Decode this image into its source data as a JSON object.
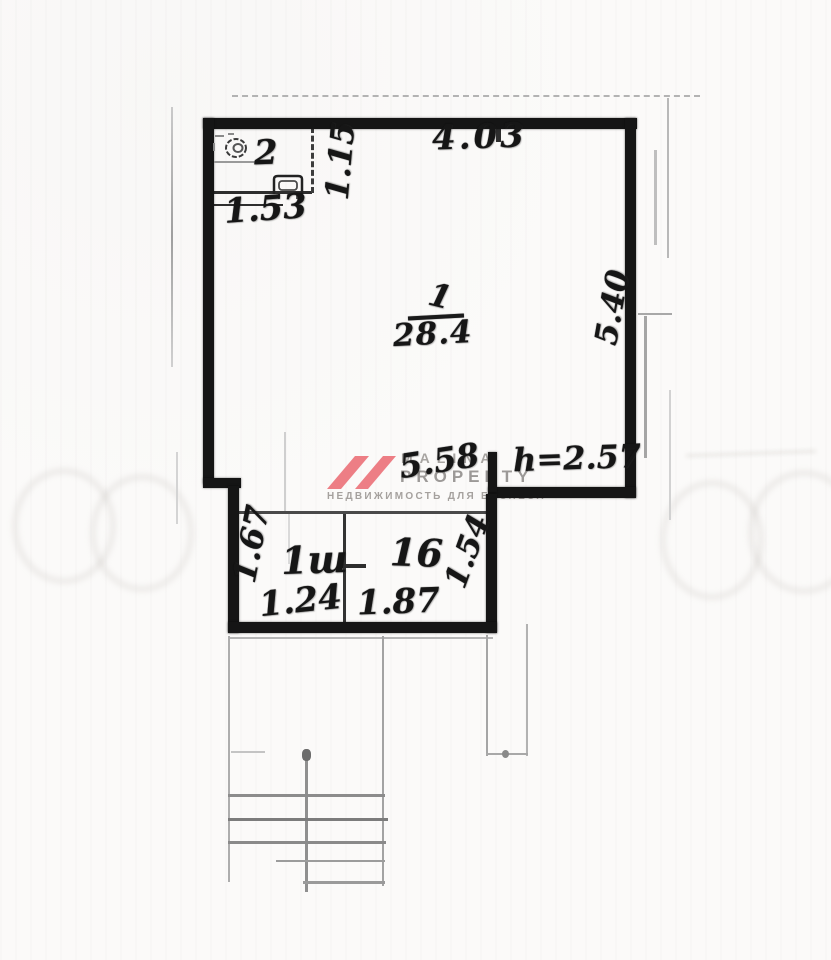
{
  "plan": {
    "room_wc": {
      "number": "2"
    },
    "room_main": {
      "number": "1",
      "area": "28.4"
    },
    "room_annex_left": {
      "label": "1ш"
    },
    "room_annex_right": {
      "label": "16"
    },
    "dims": {
      "top": "4.03",
      "wc_width": "1.53",
      "wc_depth": "1.15",
      "right_height": "5.40",
      "bottom": "5.58",
      "ceiling_height": "h=2.57",
      "annex_left_depth": "1.67",
      "annex_left_width": "1.24",
      "annex_right_width": "1.87",
      "annex_right_depth": "1.54"
    }
  },
  "watermark": {
    "name": "MALINA",
    "type_word": "PROPERTY",
    "tagline": "НЕДВИЖИМОСТЬ ДЛЯ БИЗНЕСА",
    "logo_color": "#ed7e85",
    "text_color": "#a09d9a"
  },
  "icons": {
    "toilet": "toilet-icon",
    "sink": "sink-icon"
  }
}
